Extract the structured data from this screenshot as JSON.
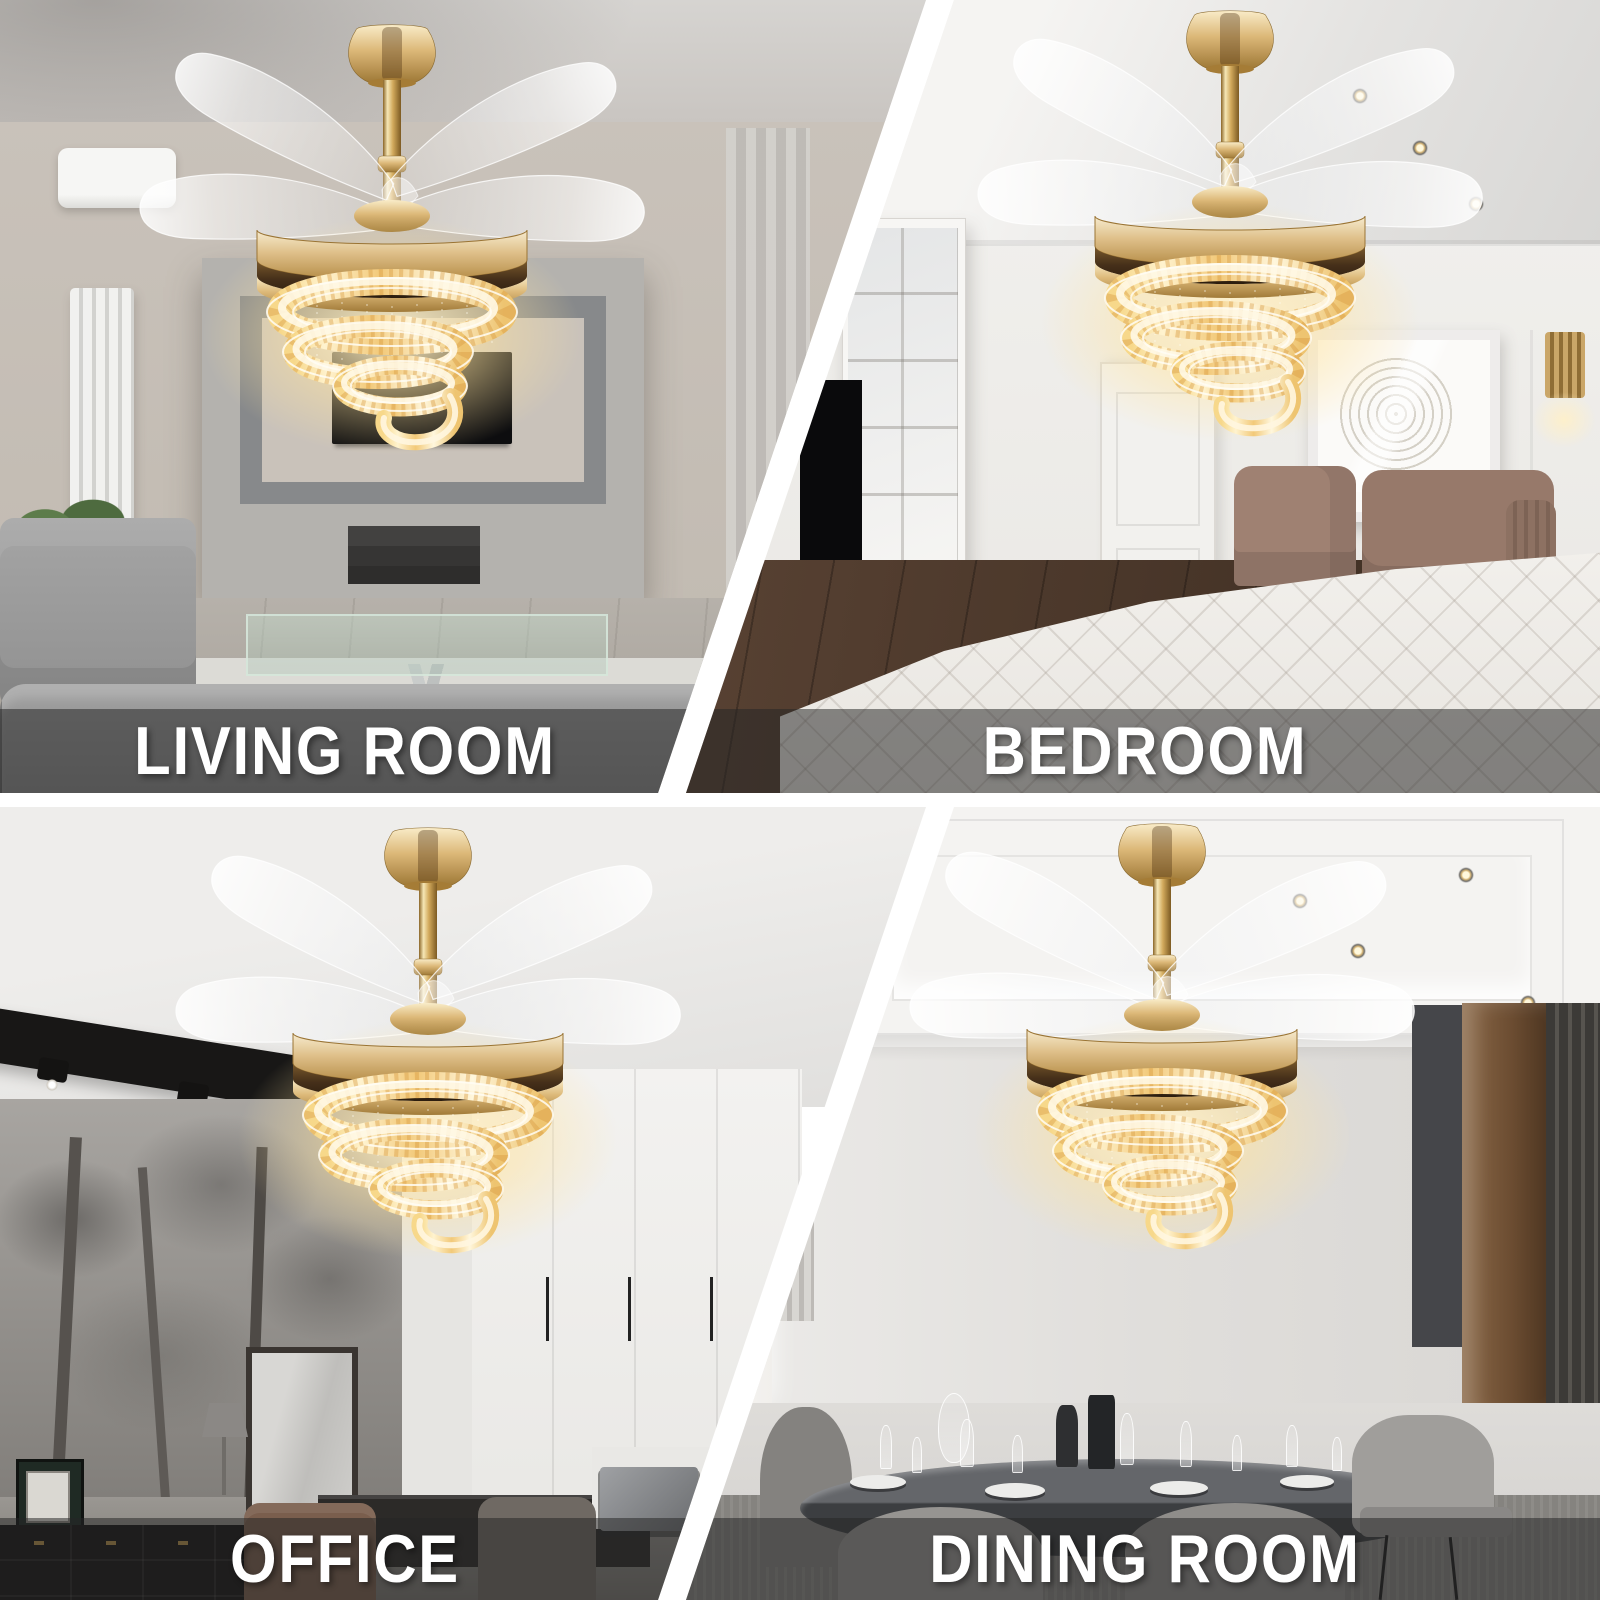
{
  "collage": {
    "type": "product-lifestyle-grid",
    "grid": "2x2",
    "product_graphic": "gold-crystal-retractable-blade-ceiling-fan-chandelier"
  },
  "quadrants": [
    {
      "id": "living-room",
      "label": "LIVING ROOM"
    },
    {
      "id": "bedroom",
      "label": "BEDROOM"
    },
    {
      "id": "office",
      "label": "OFFICE"
    },
    {
      "id": "dining-room",
      "label": "DINING ROOM"
    }
  ],
  "colors": {
    "gold_accent": "#d9b878",
    "crystal_glow": "#ffe9b3",
    "label_band": "rgba(38,38,38,0.53)",
    "label_text": "#ffffff",
    "divider": "#ffffff"
  }
}
